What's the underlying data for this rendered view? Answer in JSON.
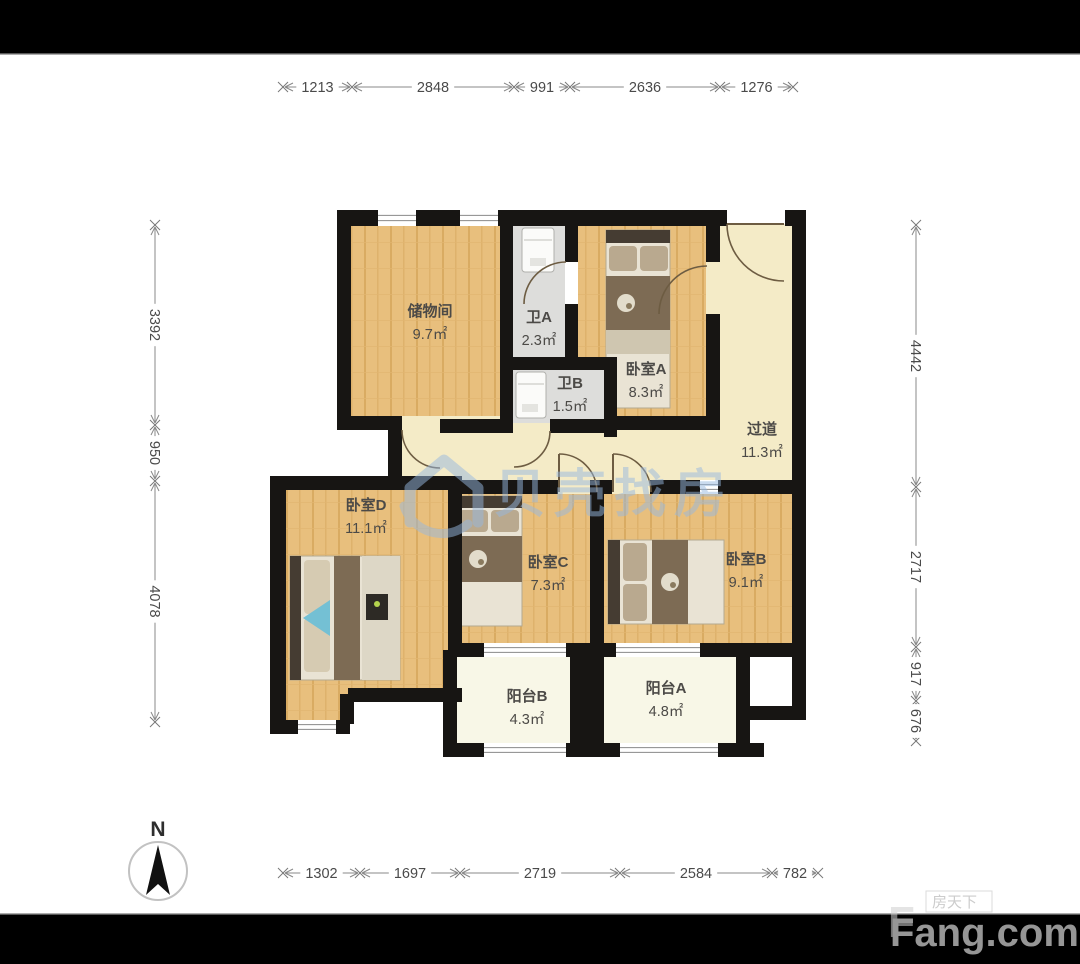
{
  "compass": {
    "label": "N"
  },
  "watermark_center": {
    "text": "贝壳找房",
    "color": "#97b8e0"
  },
  "watermark_corner": {
    "small": "房天下",
    "big": "Fang.com"
  },
  "rooms": [
    {
      "name": "储物间",
      "area": "9.7㎡",
      "x": 430,
      "y": 316
    },
    {
      "name": "卫A",
      "area": "2.3㎡",
      "x": 539,
      "y": 322
    },
    {
      "name": "卧室A",
      "area": "8.3㎡",
      "x": 646,
      "y": 374
    },
    {
      "name": "卫B",
      "area": "1.5㎡",
      "x": 570,
      "y": 388
    },
    {
      "name": "过道",
      "area": "11.3㎡",
      "x": 762,
      "y": 434
    },
    {
      "name": "卧室D",
      "area": "11.1㎡",
      "x": 366,
      "y": 510
    },
    {
      "name": "卧室C",
      "area": "7.3㎡",
      "x": 548,
      "y": 567
    },
    {
      "name": "卧室B",
      "area": "9.1㎡",
      "x": 746,
      "y": 564
    },
    {
      "name": "阳台B",
      "area": "4.3㎡",
      "x": 527,
      "y": 701
    },
    {
      "name": "阳台A",
      "area": "4.8㎡",
      "x": 666,
      "y": 693
    }
  ],
  "dims": {
    "top": {
      "axis": 87,
      "ticks": [
        283,
        352,
        514,
        570,
        720,
        793
      ],
      "labels": [
        "1213",
        "2848",
        "991",
        "2636",
        "1276"
      ]
    },
    "bottom": {
      "axis": 873,
      "ticks": [
        283,
        360,
        460,
        620,
        772,
        818
      ],
      "labels": [
        "1302",
        "1697",
        "2719",
        "2584",
        "782"
      ]
    },
    "left": {
      "axis": 155,
      "ticks": [
        225,
        425,
        481,
        722
      ],
      "labels": [
        "3392",
        "950",
        "4078"
      ]
    },
    "right": {
      "axis": 916,
      "ticks": [
        225,
        487,
        647,
        701,
        741
      ],
      "labels": [
        "4442",
        "2717",
        "917",
        "676"
      ]
    }
  },
  "floorplan": {
    "wall_color": "#171513",
    "fills": {
      "wood": "url(#woodpat)",
      "hall": "#f4ebc7",
      "bath": "#dddddb",
      "balc": "#f8f7e7"
    },
    "floors": [
      {
        "x": 402,
        "y": 416,
        "w": 391,
        "h": 78,
        "f": "hall"
      },
      {
        "x": 706,
        "y": 224,
        "w": 87,
        "h": 270,
        "f": "hall"
      },
      {
        "x": 351,
        "y": 224,
        "w": 149,
        "h": 192,
        "f": "wood"
      },
      {
        "x": 578,
        "y": 224,
        "w": 128,
        "h": 192,
        "f": "wood"
      },
      {
        "x": 513,
        "y": 224,
        "w": 52,
        "h": 133,
        "f": "bath"
      },
      {
        "x": 513,
        "y": 370,
        "w": 91,
        "h": 53,
        "f": "bath"
      },
      {
        "x": 286,
        "y": 490,
        "w": 176,
        "h": 210,
        "f": "wood"
      },
      {
        "x": 286,
        "y": 690,
        "w": 62,
        "h": 32,
        "f": "wood"
      },
      {
        "x": 461,
        "y": 494,
        "w": 130,
        "h": 149,
        "f": "wood"
      },
      {
        "x": 604,
        "y": 494,
        "w": 188,
        "h": 149,
        "f": "wood"
      },
      {
        "x": 457,
        "y": 650,
        "w": 113,
        "h": 93,
        "f": "balc"
      },
      {
        "x": 604,
        "y": 655,
        "w": 132,
        "h": 88,
        "f": "balc"
      }
    ],
    "walls": [
      [
        337,
        210,
        41,
        16
      ],
      [
        416,
        210,
        44,
        16
      ],
      [
        498,
        210,
        229,
        16
      ],
      [
        785,
        210,
        21,
        16
      ],
      [
        337,
        210,
        14,
        220
      ],
      [
        337,
        416,
        65,
        14
      ],
      [
        440,
        419,
        73,
        14
      ],
      [
        550,
        419,
        54,
        14
      ],
      [
        388,
        425,
        14,
        63
      ],
      [
        270,
        476,
        192,
        14
      ],
      [
        270,
        476,
        16,
        258
      ],
      [
        286,
        720,
        12,
        14
      ],
      [
        336,
        720,
        14,
        14
      ],
      [
        340,
        694,
        14,
        30
      ],
      [
        348,
        688,
        114,
        14
      ],
      [
        448,
        478,
        14,
        179
      ],
      [
        443,
        650,
        14,
        107
      ],
      [
        443,
        743,
        41,
        14
      ],
      [
        566,
        743,
        38,
        14
      ],
      [
        570,
        650,
        34,
        107
      ],
      [
        590,
        743,
        30,
        14
      ],
      [
        718,
        743,
        46,
        14
      ],
      [
        736,
        650,
        14,
        107
      ],
      [
        750,
        706,
        56,
        14
      ],
      [
        792,
        210,
        14,
        510
      ],
      [
        590,
        643,
        26,
        14
      ],
      [
        700,
        643,
        106,
        14
      ],
      [
        448,
        643,
        36,
        14
      ],
      [
        566,
        643,
        38,
        14
      ],
      [
        500,
        210,
        13,
        220
      ],
      [
        565,
        210,
        13,
        52
      ],
      [
        565,
        304,
        13,
        60
      ],
      [
        513,
        357,
        104,
        13
      ],
      [
        604,
        357,
        13,
        80
      ],
      [
        604,
        416,
        116,
        14
      ],
      [
        706,
        210,
        14,
        52
      ],
      [
        706,
        314,
        14,
        116
      ],
      [
        462,
        480,
        96,
        14
      ],
      [
        596,
        480,
        16,
        14
      ],
      [
        650,
        480,
        50,
        14
      ],
      [
        718,
        480,
        75,
        14
      ],
      [
        590,
        480,
        14,
        163
      ]
    ],
    "windows": [
      {
        "x": 378,
        "y": 210,
        "w": 38,
        "h": 16
      },
      {
        "x": 460,
        "y": 210,
        "w": 38,
        "h": 16
      },
      {
        "x": 298,
        "y": 720,
        "w": 38,
        "h": 14
      },
      {
        "x": 484,
        "y": 743,
        "w": 82,
        "h": 14
      },
      {
        "x": 620,
        "y": 743,
        "w": 98,
        "h": 14
      },
      {
        "x": 484,
        "y": 643,
        "w": 82,
        "h": 14
      },
      {
        "x": 616,
        "y": 643,
        "w": 84,
        "h": 14
      },
      {
        "x": 700,
        "y": 480,
        "w": 18,
        "h": 14
      }
    ],
    "doors": [
      {
        "d": "M402,430 A38,38 0 0 0 440,468"
      },
      {
        "d": "M566,262 A42,42 0 0 0 524,304"
      },
      {
        "d": "M550,431 A36,36 0 0 1 514,467"
      },
      {
        "d": "M707,266 A48,48 0 0 0 659,314"
      },
      {
        "d": "M727,224 A57,57 0 0 0 784,281",
        "leaf": [
          727,
          224,
          784,
          224
        ]
      },
      {
        "d": "M559,454 A38,38 0 0 1 597,492",
        "leaf": [
          559,
          454,
          559,
          492
        ]
      },
      {
        "d": "M613,454 A38,38 0 0 1 651,492",
        "leaf": [
          613,
          454,
          613,
          492
        ]
      }
    ],
    "decor": [
      {
        "t": "rect",
        "x": 606,
        "y": 230,
        "w": 64,
        "h": 178,
        "f": "#e9e3d4",
        "s": "#b3a890"
      },
      {
        "t": "rect",
        "x": 606,
        "y": 230,
        "w": 64,
        "h": 13,
        "f": "#453c32"
      },
      {
        "t": "rect",
        "x": 609,
        "y": 246,
        "w": 28,
        "h": 25,
        "f": "#b9a98f",
        "rx": 4
      },
      {
        "t": "rect",
        "x": 640,
        "y": 246,
        "w": 28,
        "h": 25,
        "f": "#b9a98f",
        "rx": 4
      },
      {
        "t": "rect",
        "x": 606,
        "y": 276,
        "w": 64,
        "h": 54,
        "f": "#7d6b54"
      },
      {
        "t": "circle",
        "cx": 626,
        "cy": 303,
        "r": 9,
        "f": "#e2dccb"
      },
      {
        "t": "circle",
        "cx": 629,
        "cy": 306,
        "r": 3,
        "f": "#8a7a5e"
      },
      {
        "t": "rect",
        "x": 606,
        "y": 330,
        "w": 64,
        "h": 24,
        "f": "#cfc6b0"
      },
      {
        "t": "rect",
        "x": 456,
        "y": 496,
        "w": 66,
        "h": 130,
        "f": "#e9e3d4",
        "s": "#b3a890"
      },
      {
        "t": "rect",
        "x": 456,
        "y": 496,
        "w": 66,
        "h": 12,
        "f": "#453c32"
      },
      {
        "t": "rect",
        "x": 459,
        "y": 510,
        "w": 29,
        "h": 22,
        "f": "#b9a98f",
        "rx": 4
      },
      {
        "t": "rect",
        "x": 491,
        "y": 510,
        "w": 28,
        "h": 22,
        "f": "#b9a98f",
        "rx": 4
      },
      {
        "t": "rect",
        "x": 456,
        "y": 536,
        "w": 66,
        "h": 46,
        "f": "#7d6b54"
      },
      {
        "t": "circle",
        "cx": 478,
        "cy": 559,
        "r": 9,
        "f": "#e2dccb"
      },
      {
        "t": "circle",
        "cx": 481,
        "cy": 562,
        "r": 3,
        "f": "#8a7a5e"
      },
      {
        "t": "rect",
        "x": 608,
        "y": 540,
        "w": 116,
        "h": 84,
        "f": "#e9e3d4",
        "s": "#b3a890"
      },
      {
        "t": "rect",
        "x": 608,
        "y": 540,
        "w": 12,
        "h": 84,
        "f": "#453c32"
      },
      {
        "t": "rect",
        "x": 623,
        "y": 543,
        "w": 24,
        "h": 38,
        "f": "#b9a98f",
        "rx": 4
      },
      {
        "t": "rect",
        "x": 623,
        "y": 584,
        "w": 24,
        "h": 37,
        "f": "#b9a98f",
        "rx": 4
      },
      {
        "t": "rect",
        "x": 652,
        "y": 540,
        "w": 36,
        "h": 84,
        "f": "#7d6b54"
      },
      {
        "t": "circle",
        "cx": 670,
        "cy": 582,
        "r": 9,
        "f": "#e2dccb"
      },
      {
        "t": "circle",
        "cx": 673,
        "cy": 585,
        "r": 3,
        "f": "#8a7a5e"
      },
      {
        "t": "rect",
        "x": 290,
        "y": 556,
        "w": 110,
        "h": 124,
        "f": "#e9e3d4",
        "s": "#b3a890"
      },
      {
        "t": "rect",
        "x": 290,
        "y": 556,
        "w": 11,
        "h": 124,
        "f": "#453c32"
      },
      {
        "t": "rect",
        "x": 304,
        "y": 560,
        "w": 26,
        "h": 54,
        "f": "#d6cbb2",
        "rx": 4
      },
      {
        "t": "rect",
        "x": 304,
        "y": 618,
        "w": 26,
        "h": 54,
        "f": "#d6cbb2",
        "rx": 4
      },
      {
        "t": "poly",
        "pts": "303,618 330,600 330,636",
        "f": "#74c0d4"
      },
      {
        "t": "rect",
        "x": 334,
        "y": 556,
        "w": 26,
        "h": 124,
        "f": "#7d6b54"
      },
      {
        "t": "rect",
        "x": 362,
        "y": 556,
        "w": 38,
        "h": 124,
        "f": "#ddd7c6"
      },
      {
        "t": "rect",
        "x": 366,
        "y": 594,
        "w": 22,
        "h": 26,
        "f": "#2d2a25"
      },
      {
        "t": "circle",
        "cx": 377,
        "cy": 604,
        "r": 3,
        "f": "#b5d44e"
      },
      {
        "t": "rect",
        "x": 522,
        "y": 228,
        "w": 32,
        "h": 44,
        "f": "#fbfbf9",
        "s": "#b0b0ac",
        "rx": 3
      },
      {
        "t": "line",
        "x1": 524,
        "y1": 240,
        "x2": 552,
        "y2": 240,
        "s": "#c0c0bc"
      },
      {
        "t": "rect",
        "x": 530,
        "y": 258,
        "w": 16,
        "h": 8,
        "f": "#e4e4e0"
      },
      {
        "t": "rect",
        "x": 516,
        "y": 372,
        "w": 30,
        "h": 46,
        "f": "#fbfbf9",
        "s": "#b0b0ac",
        "rx": 3
      },
      {
        "t": "line",
        "x1": 518,
        "y1": 384,
        "x2": 544,
        "y2": 384,
        "s": "#c0c0bc"
      },
      {
        "t": "rect",
        "x": 522,
        "y": 404,
        "w": 16,
        "h": 8,
        "f": "#e4e4e0"
      }
    ]
  }
}
